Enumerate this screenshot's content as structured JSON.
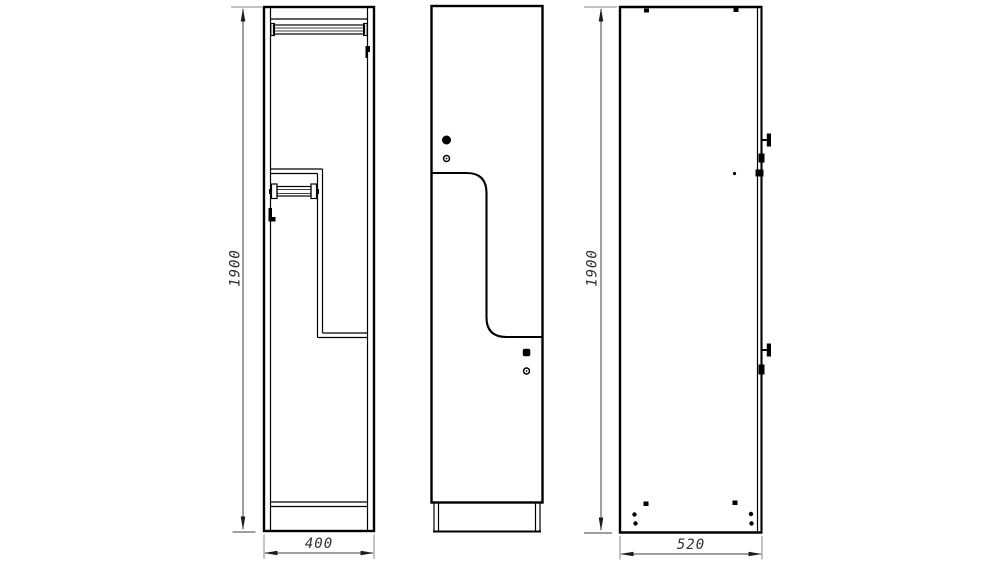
{
  "drawing": {
    "dimensions": {
      "front_height": "1900",
      "front_width": "400",
      "side_height": "1900",
      "side_depth": "520"
    },
    "colors": {
      "background": "#ffffff",
      "outline": "#000000",
      "dimension_line": "#3f3f3f",
      "extension_line": "#8a8a8a",
      "text": "#2f2f2f"
    }
  }
}
